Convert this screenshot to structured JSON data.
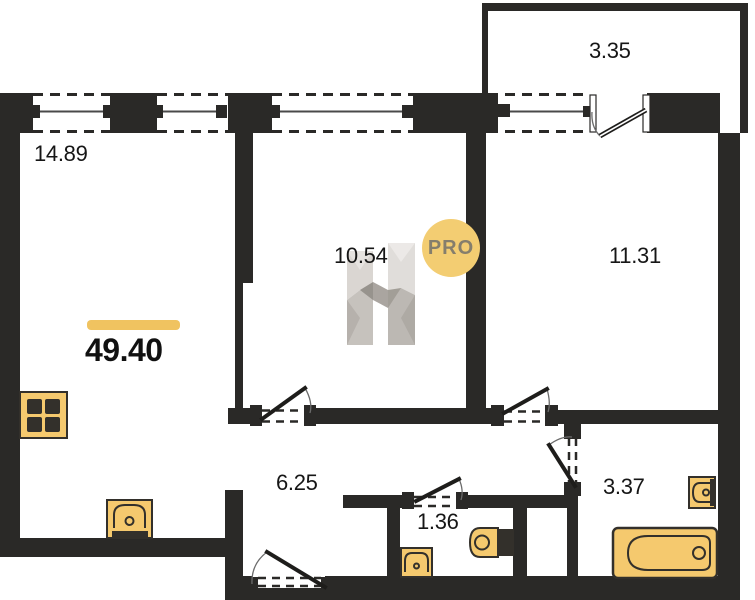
{
  "plan": {
    "total": {
      "value": "49.40"
    },
    "rooms": [
      {
        "id": "living-kitchen",
        "area": "14.89"
      },
      {
        "id": "bedroom-middle",
        "area": "10.54"
      },
      {
        "id": "bedroom-right",
        "area": "11.31"
      },
      {
        "id": "balcony",
        "area": "3.35"
      },
      {
        "id": "hallway",
        "area": "6.25"
      },
      {
        "id": "wc",
        "area": "1.36"
      },
      {
        "id": "bathroom",
        "area": "3.37"
      }
    ],
    "watermark": {
      "badge_label": "PRO",
      "logo_letter": "H"
    },
    "icons": [
      "stove-icon",
      "kitchen-sink-icon",
      "wc-sink-icon",
      "toilet-icon",
      "toilet-small-icon",
      "bathtub-icon"
    ],
    "colors": {
      "wall": "#2a2927",
      "fixture_fill": "#f5c96e",
      "fixture_stroke": "#33302b",
      "accent_bar": "#f0c360",
      "badge_bg": "#f3cd72",
      "badge_text": "#857e6c"
    }
  }
}
